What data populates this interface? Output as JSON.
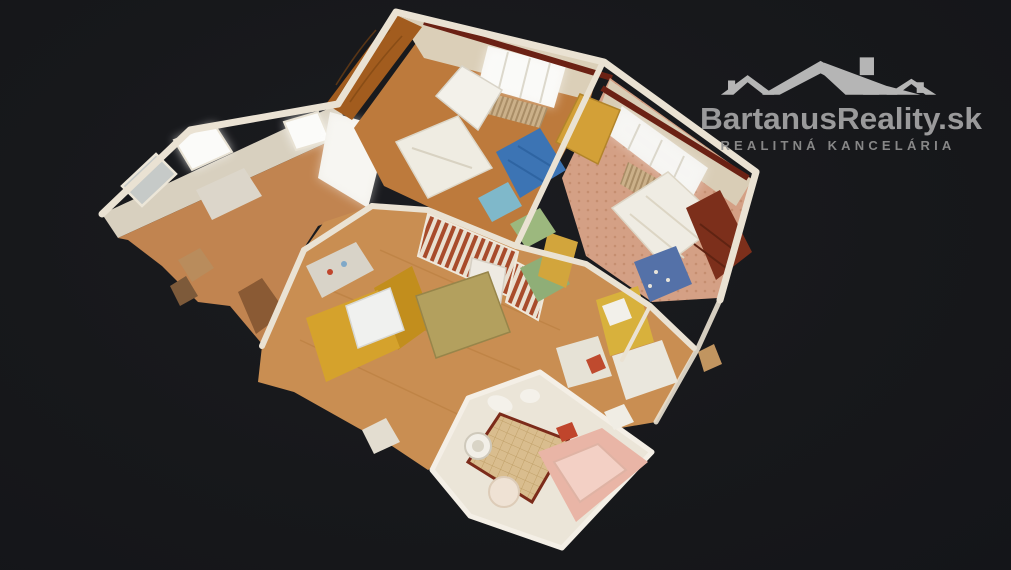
{
  "viewer": {
    "type": "3d-dollhouse-tour-view",
    "background_center": "#1b1c20",
    "background_edge": "#141519"
  },
  "watermark": {
    "brand": "BartanusReality.sk",
    "tagline": "REALITNÁ KANCELÁRIA",
    "brand_color": "#a6a6a6",
    "tagline_color": "#919191",
    "roofs_color": "#c3c3c3"
  },
  "palette": {
    "wall_cut": "#eae2d3",
    "wall_face": "#dbcfb8",
    "wood_floor": "#c98e52",
    "bedroom1_floor": "#bd7a3c",
    "osb_wall": "#a25c1e",
    "carpet_salmon": "#d4a085",
    "mat_blue": "#3c74b4",
    "sofa_yellow": "#d5a22c",
    "wardrobe_maroon": "#7c2f1b",
    "valance_maroon": "#6b2114",
    "tub_pink": "#e9b5a6",
    "tile_floor": "#d9bd8e",
    "window_glow": "#fbfbf9",
    "wing_floor": "#c18450"
  },
  "scene": {
    "description": "top-down cutaway 3D scan of furnished apartment",
    "rooms": [
      {
        "name": "hall-loggia",
        "position": "left-wing",
        "features": [
          "bright windows",
          "wood floor",
          "ragged scan edge"
        ]
      },
      {
        "name": "bedroom-children",
        "position": "top-middle",
        "features": [
          "osb wood wall",
          "white bed",
          "blue mat",
          "window with curtain",
          "radiator",
          "white boiler"
        ]
      },
      {
        "name": "bedroom-master",
        "position": "top-right",
        "features": [
          "salmon dotted carpet",
          "white double bed",
          "maroon wardrobe",
          "yellow wardrobe",
          "blue floral armchair",
          "window with curtain"
        ]
      },
      {
        "name": "kitchen-living",
        "position": "center-left",
        "features": [
          "yellow corner sofa",
          "white table",
          "tan table",
          "fridge",
          "sink counter",
          "striped wainscot hallway"
        ]
      },
      {
        "name": "study",
        "position": "center-right",
        "features": [
          "yellow desk",
          "white desk",
          "shelf"
        ]
      },
      {
        "name": "bathroom",
        "position": "bottom",
        "features": [
          "beige tile floor",
          "pink bathtub",
          "washing machine",
          "sink",
          "round stool"
        ]
      }
    ]
  }
}
